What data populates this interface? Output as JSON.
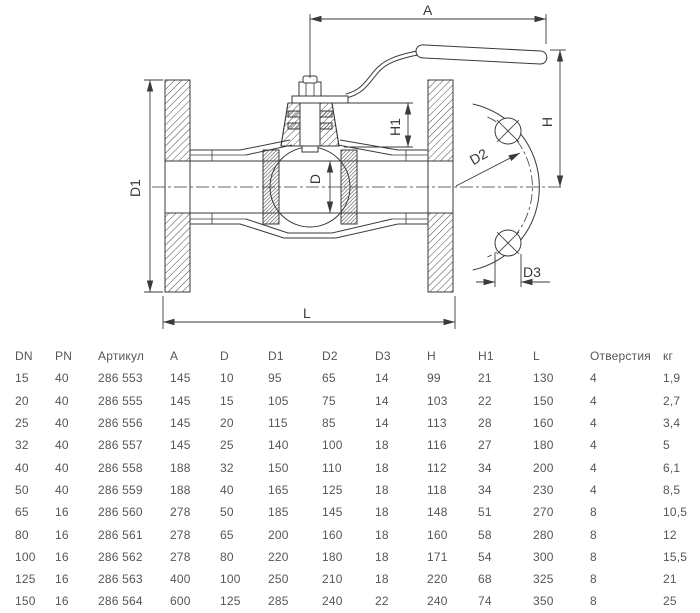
{
  "drawing": {
    "type": "technical-section-drawing",
    "subject": "flanged ball valve with lever handle, side section and partial flange end view",
    "dims": {
      "A": "A",
      "H": "H",
      "H1": "H1",
      "D": "D",
      "D1": "D1",
      "D2": "D2",
      "D3": "D3",
      "L": "L"
    },
    "line_color": "#3a3a3a"
  },
  "table": {
    "headers": [
      "DN",
      "PN",
      "Артикул",
      "A",
      "D",
      "D1",
      "D2",
      "D3",
      "H",
      "H1",
      "L",
      "Отверстия",
      "кг"
    ],
    "rows": [
      [
        "15",
        "40",
        "286 553",
        "145",
        "10",
        "95",
        "65",
        "14",
        "99",
        "21",
        "130",
        "4",
        "1,9"
      ],
      [
        "20",
        "40",
        "286 555",
        "145",
        "15",
        "105",
        "75",
        "14",
        "103",
        "22",
        "150",
        "4",
        "2,7"
      ],
      [
        "25",
        "40",
        "286 556",
        "145",
        "20",
        "115",
        "85",
        "14",
        "113",
        "28",
        "160",
        "4",
        "3,4"
      ],
      [
        "32",
        "40",
        "286 557",
        "145",
        "25",
        "140",
        "100",
        "18",
        "116",
        "27",
        "180",
        "4",
        "5"
      ],
      [
        "40",
        "40",
        "286 558",
        "188",
        "32",
        "150",
        "110",
        "18",
        "112",
        "34",
        "200",
        "4",
        "6,1"
      ],
      [
        "50",
        "40",
        "286 559",
        "188",
        "40",
        "165",
        "125",
        "18",
        "118",
        "34",
        "230",
        "4",
        "8,5"
      ],
      [
        "65",
        "16",
        "286 560",
        "278",
        "50",
        "185",
        "145",
        "18",
        "148",
        "51",
        "270",
        "8",
        "10,5"
      ],
      [
        "80",
        "16",
        "286 561",
        "278",
        "65",
        "200",
        "160",
        "18",
        "160",
        "58",
        "280",
        "8",
        "12"
      ],
      [
        "100",
        "16",
        "286 562",
        "278",
        "80",
        "220",
        "180",
        "18",
        "171",
        "54",
        "300",
        "8",
        "15,5"
      ],
      [
        "125",
        "16",
        "286 563",
        "400",
        "100",
        "250",
        "210",
        "18",
        "220",
        "68",
        "325",
        "8",
        "21"
      ],
      [
        "150",
        "16",
        "286 564",
        "600",
        "125",
        "285",
        "240",
        "22",
        "240",
        "74",
        "350",
        "8",
        "25"
      ]
    ]
  },
  "colors": {
    "background": "#ffffff",
    "drawing_lines": "#3a3a3a",
    "table_text": "#55565a"
  }
}
